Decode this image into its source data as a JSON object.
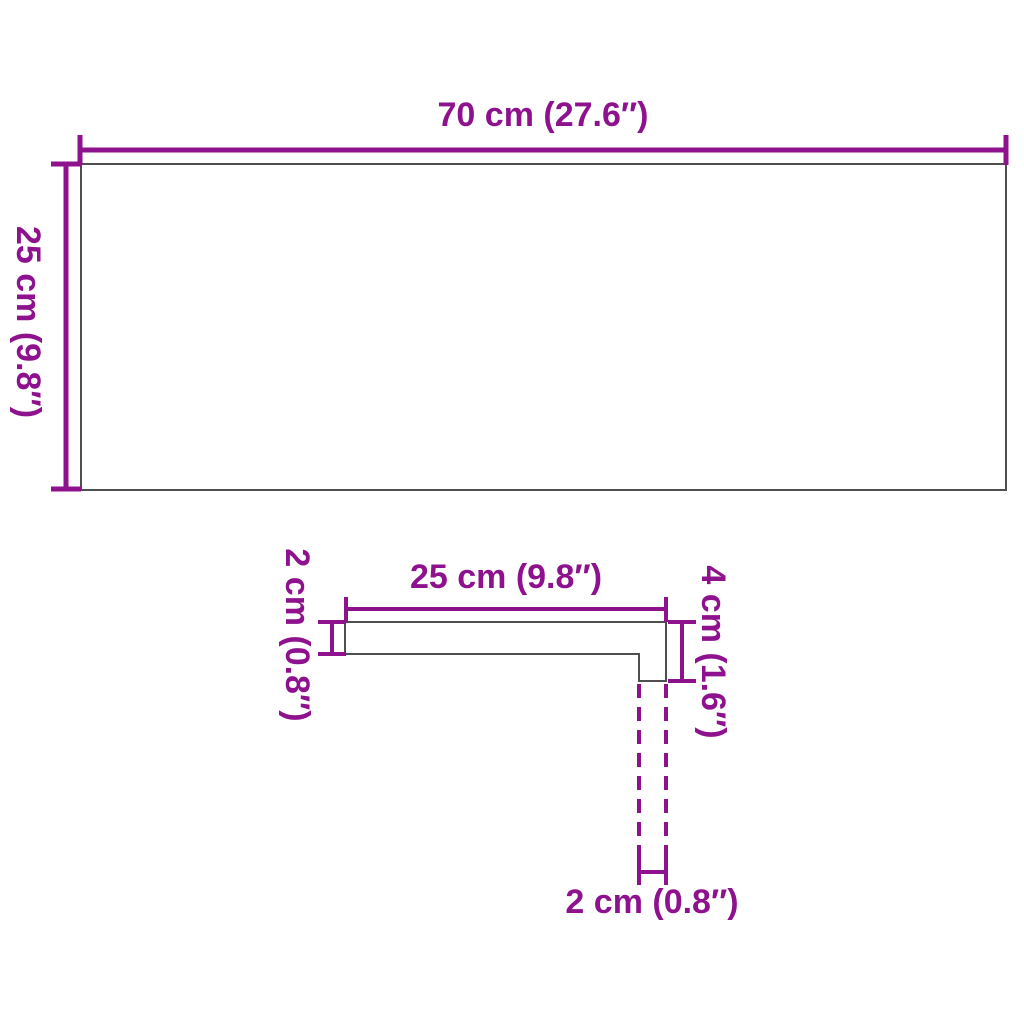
{
  "colors": {
    "dimension": "#8E128E",
    "outline": "#4F4F4F",
    "background": "#FFFFFF"
  },
  "top_view": {
    "width_label": "70 cm (27.6″)",
    "height_label": "25 cm (9.8″)"
  },
  "profile_view": {
    "top_width_label": "25 cm (9.8″)",
    "thickness_label": "2 cm (0.8″)",
    "total_height_label": "4 cm (1.6″)",
    "nosing_width_label": "2 cm (0.8″)"
  }
}
